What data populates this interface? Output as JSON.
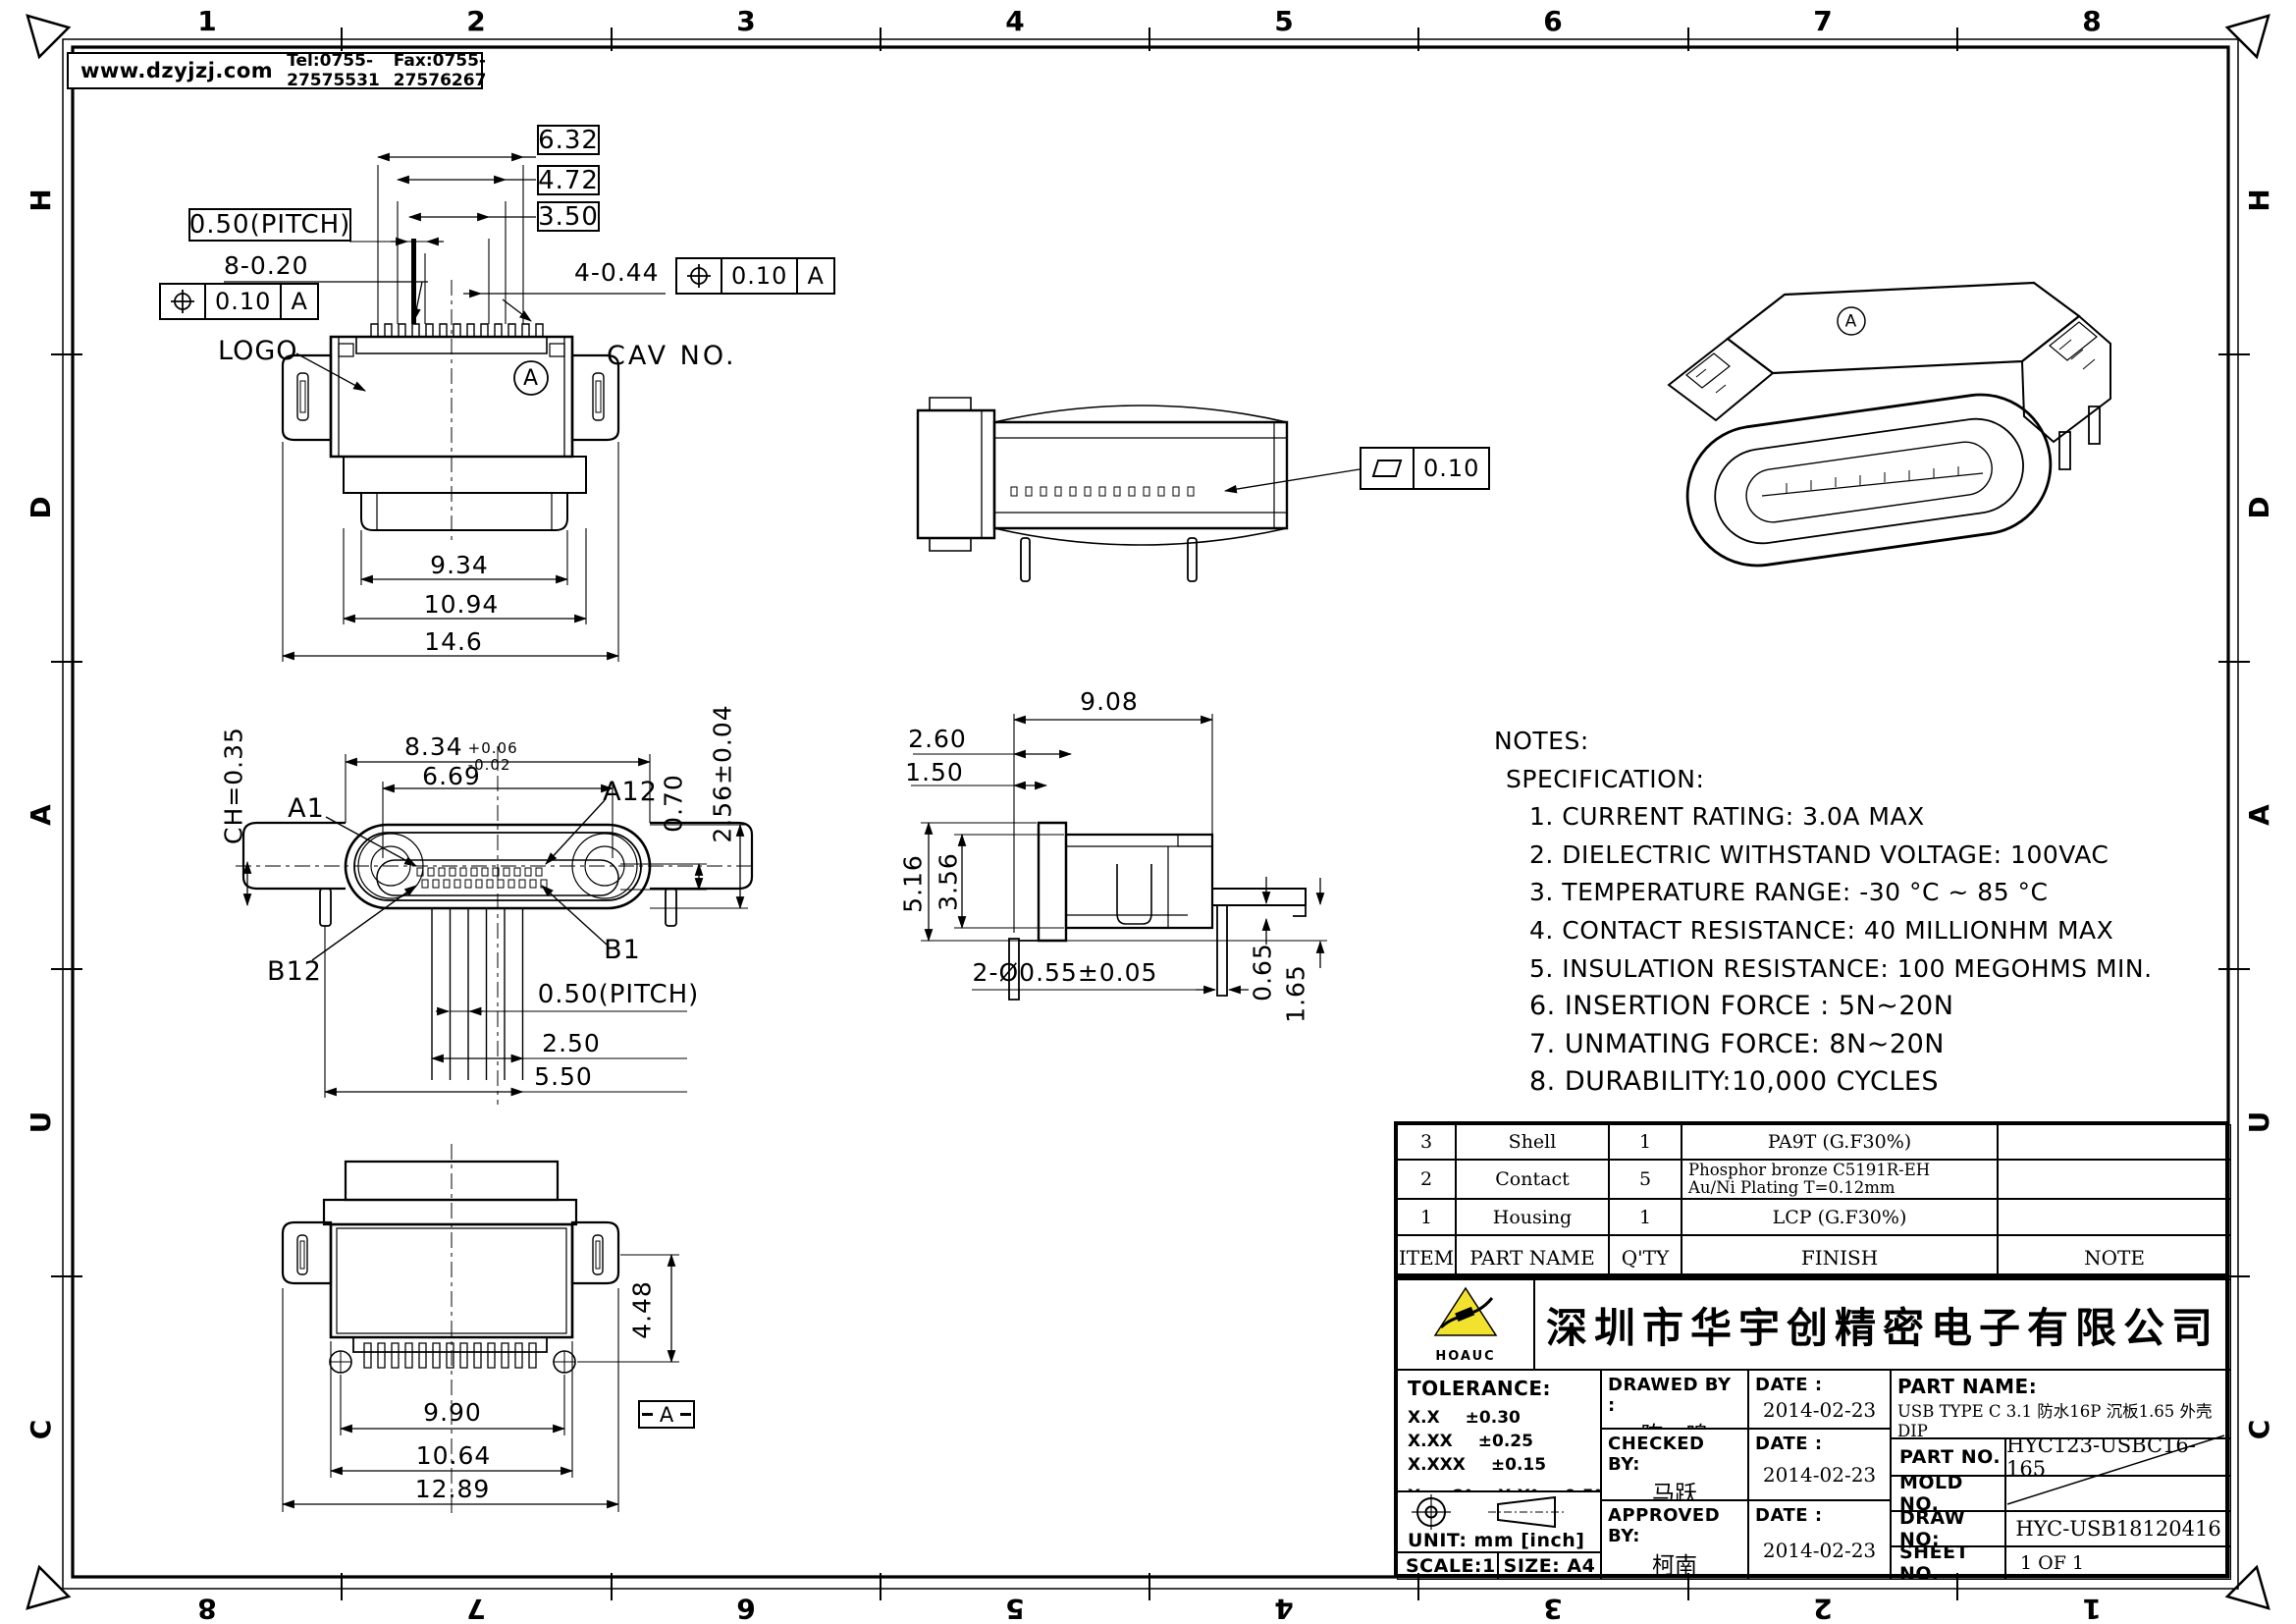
{
  "header": {
    "website": "www.dzyjzj.com",
    "tel": "Tel:0755-27575531",
    "fax": "Fax:0755-27576267"
  },
  "border": {
    "top": [
      "1",
      "2",
      "3",
      "4",
      "5",
      "6",
      "7",
      "8"
    ],
    "bottom": [
      "8",
      "7",
      "6",
      "5",
      "4",
      "3",
      "2",
      "1"
    ],
    "left": [
      "H",
      "D",
      "A",
      "U",
      "C"
    ],
    "right": [
      "H",
      "D",
      "A",
      "U",
      "C"
    ]
  },
  "views": {
    "top": {
      "boxed_dims": [
        "6.32",
        "4.72",
        "3.50"
      ],
      "pitch_boxed": "0.50(PITCH)",
      "dim_8_020": "8-0.20",
      "dim_4_044": "4-0.44",
      "fcf_tol": "0.10",
      "fcf_datum": "A",
      "logo_label": "LOGO",
      "cav_label": "CAV NO.",
      "datum_label": "A",
      "dim_934": "9.34",
      "dim_1094": "10.94",
      "dim_146": "14.6"
    },
    "face": {
      "ch": "CH=0.35",
      "dim_834": "8.34",
      "tol_plus": "+0.06",
      "tol_minus": "-0.02",
      "dim_669": "6.69",
      "pin_a1": "A1",
      "pin_a12": "A12",
      "pin_b1": "B1",
      "pin_b12": "B12",
      "dim_070": "0.70",
      "dim_256": "2.56±0.04",
      "pitch": "0.50(PITCH)",
      "dim_250": "2.50",
      "dim_550": "5.50"
    },
    "side": {
      "flatness_tol": "0.10"
    },
    "section": {
      "dim_908": "9.08",
      "dim_260": "2.60",
      "dim_150": "1.50",
      "dim_516": "5.16",
      "dim_356": "3.56",
      "dim_holes": "2-Ø0.55±0.05",
      "dim_065": "0.65",
      "dim_165": "1.65"
    },
    "bottom": {
      "dim_448": "4.48",
      "dim_990": "9.90",
      "dim_1064": "10.64",
      "dim_1289": "12.89",
      "datum_label": "A"
    },
    "iso": {
      "datum_label": "A"
    }
  },
  "notes": {
    "title": "NOTES:",
    "subtitle": "SPECIFICATION:",
    "items": [
      "1. CURRENT RATING: 3.0A MAX",
      "2. DIELECTRIC WITHSTAND VOLTAGE: 100VAC",
      "3. TEMPERATURE RANGE: -30 °C ~ 85 °C",
      "4. CONTACT RESISTANCE: 40 MILLIONHM MAX",
      "5. INSULATION RESISTANCE: 100 MEGOHMS MIN.",
      "6. INSERTION FORCE : 5N~20N",
      "7. UNMATING FORCE: 8N~20N",
      "8. DURABILITY:10,000 CYCLES"
    ]
  },
  "parts_table": {
    "headers": {
      "item": "ITEM",
      "part_name": "PART NAME",
      "qty": "Q'TY",
      "finish": "FINISH",
      "note": "NOTE"
    },
    "rows": [
      {
        "item": "3",
        "part_name": "Shell",
        "qty": "1",
        "finish_lines": [
          "PA9T (G.F30%)"
        ],
        "note": ""
      },
      {
        "item": "2",
        "part_name": "Contact",
        "qty": "5",
        "finish_lines": [
          "Phosphor bronze C5191R-EH",
          "Au/Ni Plating T=0.12mm"
        ],
        "note": ""
      },
      {
        "item": "1",
        "part_name": "Housing",
        "qty": "1",
        "finish_lines": [
          "LCP (G.F30%)"
        ],
        "note": ""
      }
    ]
  },
  "title_block": {
    "logo_text": "HOAUC",
    "company": "深圳市华宇创精密电子有限公司",
    "tolerance_label": "TOLERANCE:",
    "tol_rows": [
      {
        "label": "X.X",
        "value": "±0.30"
      },
      {
        "label": "X.XX",
        "value": "±0.25"
      },
      {
        "label": "X.XXX",
        "value": "±0.15"
      }
    ],
    "tol_ang1_label": "X.°",
    "tol_ang1_value": "±2°",
    "tol_ang2_label": "X.X°",
    "tol_ang2_value": "±0.5°",
    "unit_label": "UNIT: mm [inch]",
    "scale_label": "SCALE:1:1",
    "size_label": "SIZE: A4",
    "drawn_label": "DRAWED BY :",
    "drawn_name": "陈一鸣",
    "checked_label": "CHECKED BY:",
    "checked_name": "马跃",
    "approved_label": "APPROVED BY:",
    "approved_name": "柯南",
    "date_label": "DATE :",
    "drawn_date": "2014-02-23",
    "checked_date": "2014-02-23",
    "approved_date": "2014-02-23",
    "part_name_label": "PART NAME:",
    "part_name": "USB TYPE C 3.1 防水16P 沉板1.65 外壳DIP",
    "part_no_label": "PART NO.",
    "part_no": "HYC123-USBC16-165",
    "mold_no_label": "MOLD NO.",
    "draw_no_label": "DRAW NO:",
    "draw_no": "HYC-USB18120416",
    "sheet_no_label": "SHEET NO.",
    "sheet_no": "1 OF 1"
  }
}
